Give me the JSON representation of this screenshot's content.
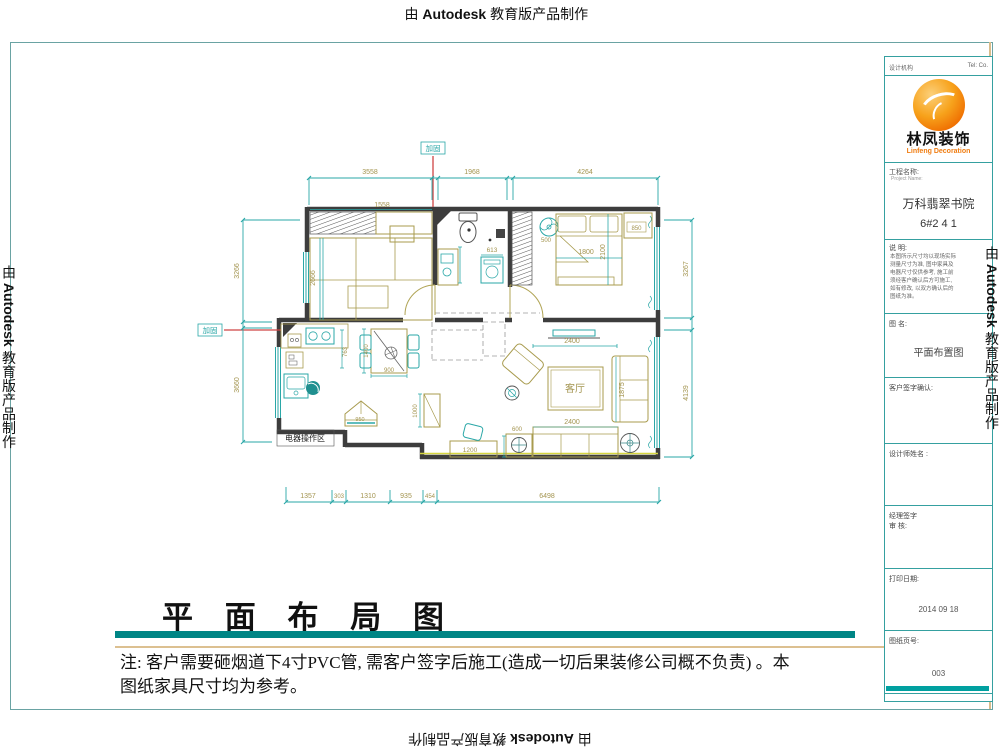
{
  "stamp": {
    "prefix": "由",
    "brand": "Autodesk",
    "suffix": "教育版产品制作"
  },
  "title_block": {
    "agency_label": "设计机构",
    "tel_label": "Tel:  Co.",
    "logo": {
      "cn": "林凤装饰",
      "en": "Linfeng Decoration"
    },
    "project_label": "工程名称:",
    "project_sub": "Project Name:",
    "project_name": "万科翡翠书院",
    "project_unit": "6#2 4 1",
    "notes_label": "说 明:",
    "notes_text": "本图所示尺寸均以现场实际\n测量尺寸为准, 图中家具及\n电器尺寸仅供参考, 施工前\n须经客户确认后方可施工,\n如有修改, 以双方确认后的\n图纸为准。",
    "drawing_label": "图 名:",
    "drawing_name": "平面布置图",
    "client_sign_label": "客户签字确认:",
    "designer_label": "设计师姓名 :",
    "manager_label": "经理签字",
    "review_label": "审 核:",
    "print_date_label": "打印日期:",
    "print_date": "2014 09 18",
    "page_label": "图纸页号:",
    "page_number": "003"
  },
  "footer": {
    "title": "平 面 布 局 图",
    "note_line1": "注: 客户需要砸烟道下4寸PVC管, 需客户签字后施工(造成一切后果装修公司概不负责) 。本",
    "note_line2": "图纸家具尺寸均为参考。"
  },
  "plan": {
    "room_label_living": "客厅",
    "zone_label": "电器操作区",
    "reinforce_label": "加固",
    "dims": {
      "top1": "3558",
      "top2": "1968",
      "top3": "4264",
      "bottom1": "1357",
      "bottom2": "303",
      "bottom3": "1310",
      "bottom4": "935",
      "bottom5": "454",
      "bottom6": "6498",
      "left1": "3266",
      "left2": "3660",
      "right1": "3267",
      "right2": "4139",
      "wardrobe": "1558",
      "room1_width": "2666",
      "bath": "613",
      "bed_w": "1800",
      "bed_l": "2100",
      "nightstand": "850",
      "fan": "500",
      "tv": "2400",
      "sofa_side": "1875",
      "sofa": "2400",
      "desk": "1200",
      "side_table": "600",
      "dining_l": "1400",
      "dining_w": "900",
      "counter": "763",
      "island": "950",
      "cabinet": "1000"
    }
  }
}
